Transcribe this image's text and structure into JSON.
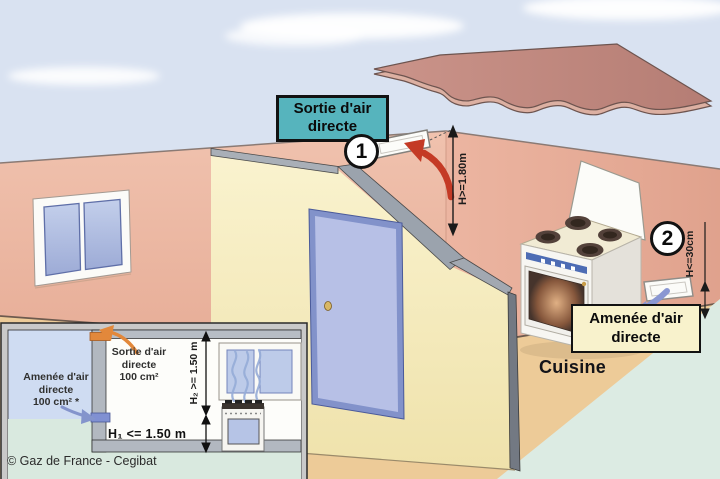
{
  "diagram": {
    "outlet_label": {
      "line1": "Sortie d'air",
      "line2": "directe"
    },
    "inlet_label": {
      "line1": "Amenée d'air",
      "line2": "directe"
    },
    "step1": "1",
    "step2": "2",
    "dim_h2": "H>=1.80m",
    "dim_hc": "H<=30cm",
    "room": "Cuisine"
  },
  "inset": {
    "outlet": {
      "line1": "Sortie d'air",
      "line2": "directe",
      "line3": "100 cm²"
    },
    "inlet": {
      "line1": "Amenée d'air",
      "line2": "directe",
      "line3": "100 cm² *"
    },
    "dim_h2": "H₂ >= 1.50 m",
    "dim_h1": "H₁ <= 1.50 m"
  },
  "credit": "© Gaz de France - Cegibat",
  "colors": {
    "sky": "#d9e2f1",
    "roof": "#c08379",
    "wall_left": "#ecb7a3",
    "wall_right": "#e6ab97",
    "partition": "#f8f0c6",
    "floor": "#edcb98",
    "outside_ground": "#dcebe3",
    "door": "#b7c0e6",
    "outlet_box_bg": "#56b4bd",
    "inlet_box_bg": "#f8f2cc",
    "exhaust_arrow": "#c43a25",
    "supply_arrow": "#8a97d2",
    "inset_exhaust_arrow": "#e2883b"
  }
}
